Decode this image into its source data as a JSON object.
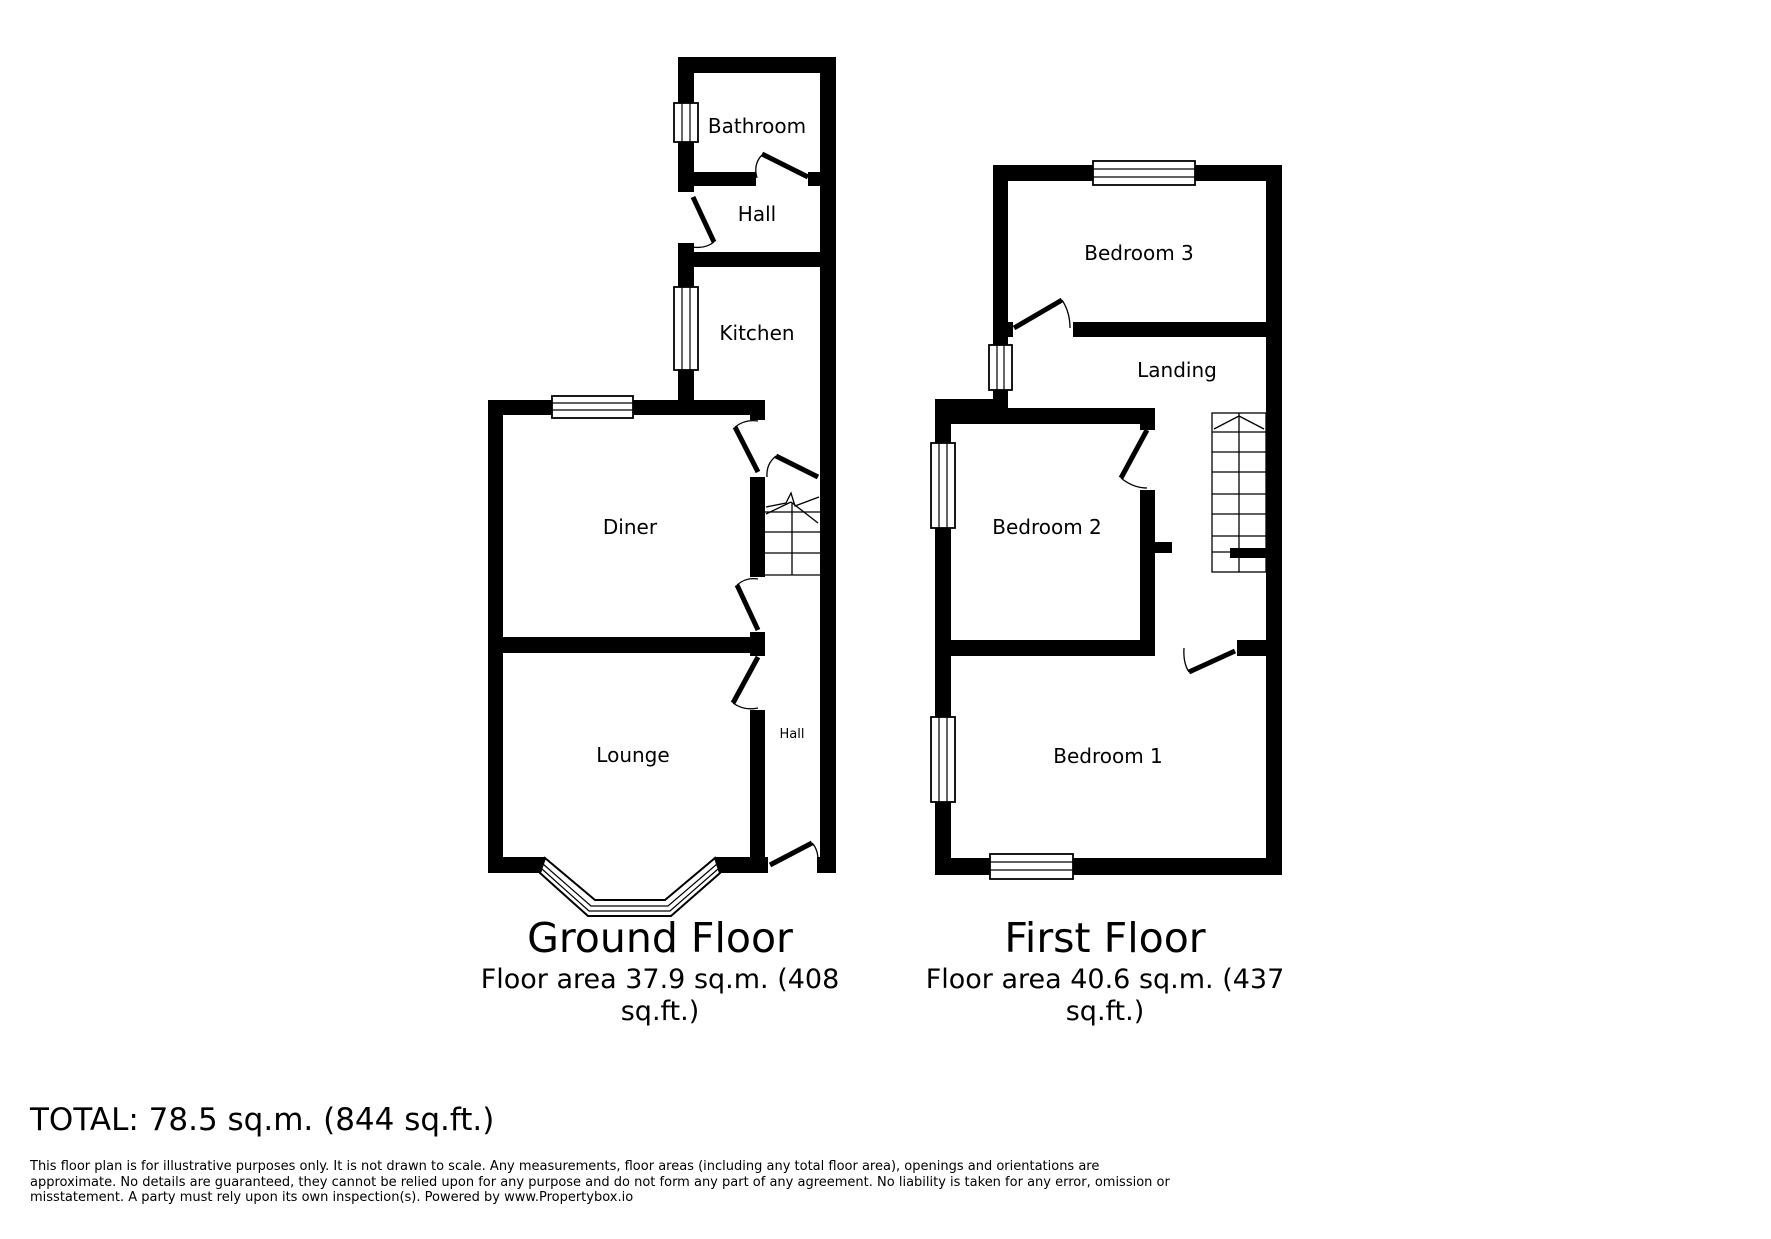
{
  "colors": {
    "ink": "#000000",
    "paper": "#ffffff"
  },
  "floors": [
    {
      "title": "Ground Floor",
      "area_lines": [
        "Floor area 37.9 sq.m. (408",
        "sq.ft.)"
      ],
      "rooms": [
        {
          "label": "Bathroom"
        },
        {
          "label": "Hall"
        },
        {
          "label": "Kitchen"
        },
        {
          "label": "Diner"
        },
        {
          "label": "Lounge"
        },
        {
          "label": "Hall"
        }
      ]
    },
    {
      "title": "First Floor",
      "area_lines": [
        "Floor area 40.6 sq.m. (437",
        "sq.ft.)"
      ],
      "rooms": [
        {
          "label": "Bedroom 3"
        },
        {
          "label": "Landing"
        },
        {
          "label": "Bedroom 2"
        },
        {
          "label": "Bedroom 1"
        }
      ]
    }
  ],
  "total_label": "TOTAL: 78.5 sq.m. (844 sq.ft.)",
  "disclaimer_lines": [
    "This floor plan is for illustrative purposes only. It is not drawn to scale. Any measurements, floor areas (including any total floor area), openings and orientations are",
    "approximate. No details are guaranteed, they cannot be relied upon for any purpose and do not form any part of any agreement. No liability is taken for any error, omission or",
    "misstatement. A party must rely upon its own inspection(s). Powered by www.Propertybox.io"
  ]
}
